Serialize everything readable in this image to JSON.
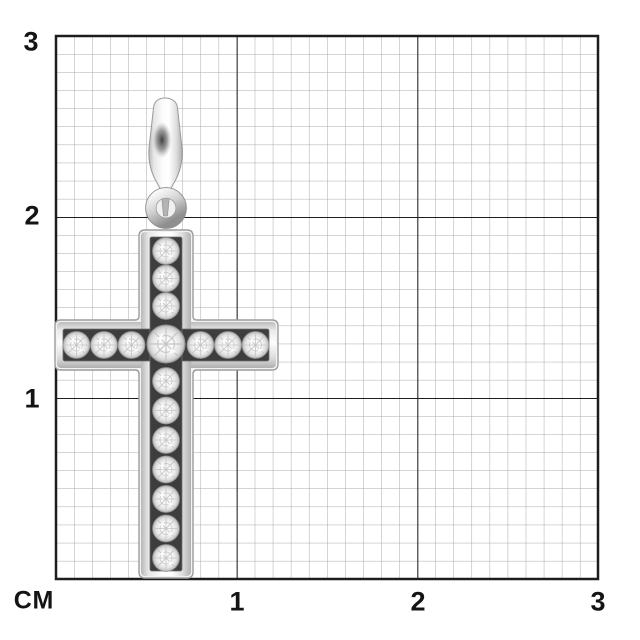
{
  "meta": {
    "description": "Jewelry size-reference image: white-gold cross pendant with channel-set diamonds photographed over a centimeter grid"
  },
  "ruler": {
    "unit_label": "СМ",
    "x_tick_labels": [
      "1",
      "2",
      "3"
    ],
    "y_tick_labels": [
      "3",
      "2",
      "1"
    ],
    "minor_cells_per_cm": 10,
    "cm_span": 3
  },
  "colors": {
    "background": "#ffffff",
    "grid_minor": "#a9a9a9",
    "grid_major": "#1d1d1d",
    "label_text": "#141414",
    "metal_light": "#fbfbfb",
    "metal_dark": "#b5b5b5",
    "channel_dark": "#3d3d3d"
  },
  "pendant": {
    "description": "White metal cross pendant with tapered bail, jump ring and channel-set round diamonds",
    "stones_vertical_above_center": 3,
    "stones_vertical_below_center": 7,
    "stones_horizontal": 6,
    "stones_center": 1,
    "stone_count_total": 17
  }
}
